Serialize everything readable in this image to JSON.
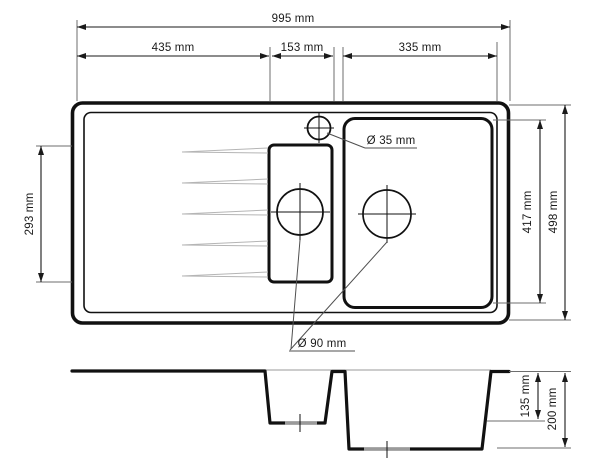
{
  "drawing": {
    "type": "technical-drawing",
    "subject": "kitchen sink with drainer, one and a half bowls, top view and cross-section",
    "views": [
      "top-view",
      "section-view"
    ],
    "colors": {
      "background": "#ffffff",
      "outline": "#111111",
      "dimension": "#1a1a1a",
      "extension": "#6e6e6e",
      "groove": "#b5b5b5",
      "drain_recess": "#9a9a9a"
    },
    "labels": {
      "overall_width": "995 mm",
      "drainer_width": "435 mm",
      "half_bowl_width": "153 mm",
      "main_bowl_width": "335 mm",
      "drainer_height": "293 mm",
      "main_bowl_height": "417 mm",
      "overall_depth": "498 mm",
      "faucet_hole_diameter": "Ø 35 mm",
      "drain_hole_diameter": "Ø 90 mm",
      "half_bowl_depth": "135 mm",
      "main_bowl_depth": "200 mm"
    }
  }
}
